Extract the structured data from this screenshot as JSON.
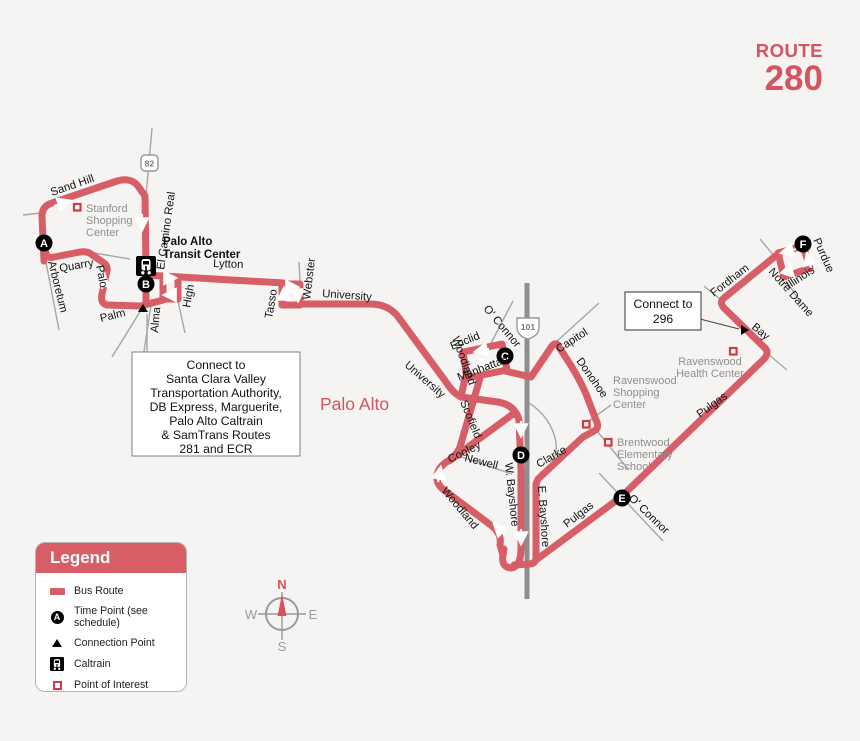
{
  "title": {
    "kicker": "ROUTE",
    "number": "280"
  },
  "map": {
    "city": "Palo Alto",
    "shields": {
      "hwy_82": "82",
      "hwy_101": "101"
    },
    "time_points": [
      "A",
      "B",
      "C",
      "D",
      "E",
      "F"
    ],
    "streets": {
      "sand_hill": "Sand Hill",
      "quarry": "Quarry",
      "arboretum": "Arboretum",
      "palo": "Palo",
      "palm": "Palm",
      "alma": "Alma",
      "el_camino_real": "El Camino Real",
      "high": "High",
      "lytton": "Lytton",
      "tasso": "Tasso",
      "webster": "Webster",
      "university_1": "University",
      "university_2": "University",
      "woodland_1": "Woodland",
      "woodland_2": "Woodland",
      "euclid": "Euclid",
      "o_connor_1": "O' Connor",
      "o_connor_2": "O' Connor",
      "manhattan": "Manhattan",
      "capitol": "Capitol",
      "donohoe": "Donohoe",
      "scofield": "Scofield",
      "cooley": "Cooley",
      "newell": "Newell",
      "clarke": "Clarke",
      "w_bayshore": "W. Bayshore",
      "e_bayshore": "E. Bayshore",
      "pulgas_1": "Pulgas",
      "pulgas_2": "Pulgas",
      "bay": "Bay",
      "fordham": "Fordham",
      "notre_dame": "Notre Dame",
      "illinois": "Illinois",
      "purdue": "Purdue"
    },
    "pois": {
      "stanford_shopping_center": {
        "lines": [
          "Stanford",
          "Shopping",
          "Center"
        ]
      },
      "ravenswood_shopping_center": {
        "lines": [
          "Ravenswood",
          "Shopping",
          "Center"
        ]
      },
      "brentwood_elementary_school": {
        "lines": [
          "Brentwood",
          "Elementary",
          "School"
        ]
      },
      "ravenswood_health_center": {
        "lines": [
          "Ravenswood",
          "Health Center"
        ]
      }
    },
    "transit_center": {
      "lines": [
        "Palo Alto",
        "Transit Center"
      ]
    },
    "callouts": {
      "vta": {
        "lines": [
          "Connect to",
          "Santa Clara Valley",
          "Transportation Authority,",
          "DB Express, Marguerite,",
          "Palo Alto Caltrain",
          "& SamTrans Routes",
          "281 and ECR"
        ]
      },
      "route_296": {
        "lines": [
          "Connect to",
          "296"
        ]
      }
    }
  },
  "legend": {
    "title": "Legend",
    "sample_letter": "A",
    "items": [
      "Bus Route",
      "Time Point (see schedule)",
      "Connection Point",
      "Caltrain",
      "Point of Interest"
    ]
  },
  "compass": {
    "n": "N",
    "e": "E",
    "s": "S",
    "w": "W"
  },
  "colors": {
    "route": "#d75e66",
    "accent_text": "#d4545f",
    "poi_square": "#cf3a44",
    "freeway": "#8e8e8e",
    "street": "#a6a6a6",
    "gray_text": "#8f8f8f",
    "background": "#f5f4f2"
  }
}
